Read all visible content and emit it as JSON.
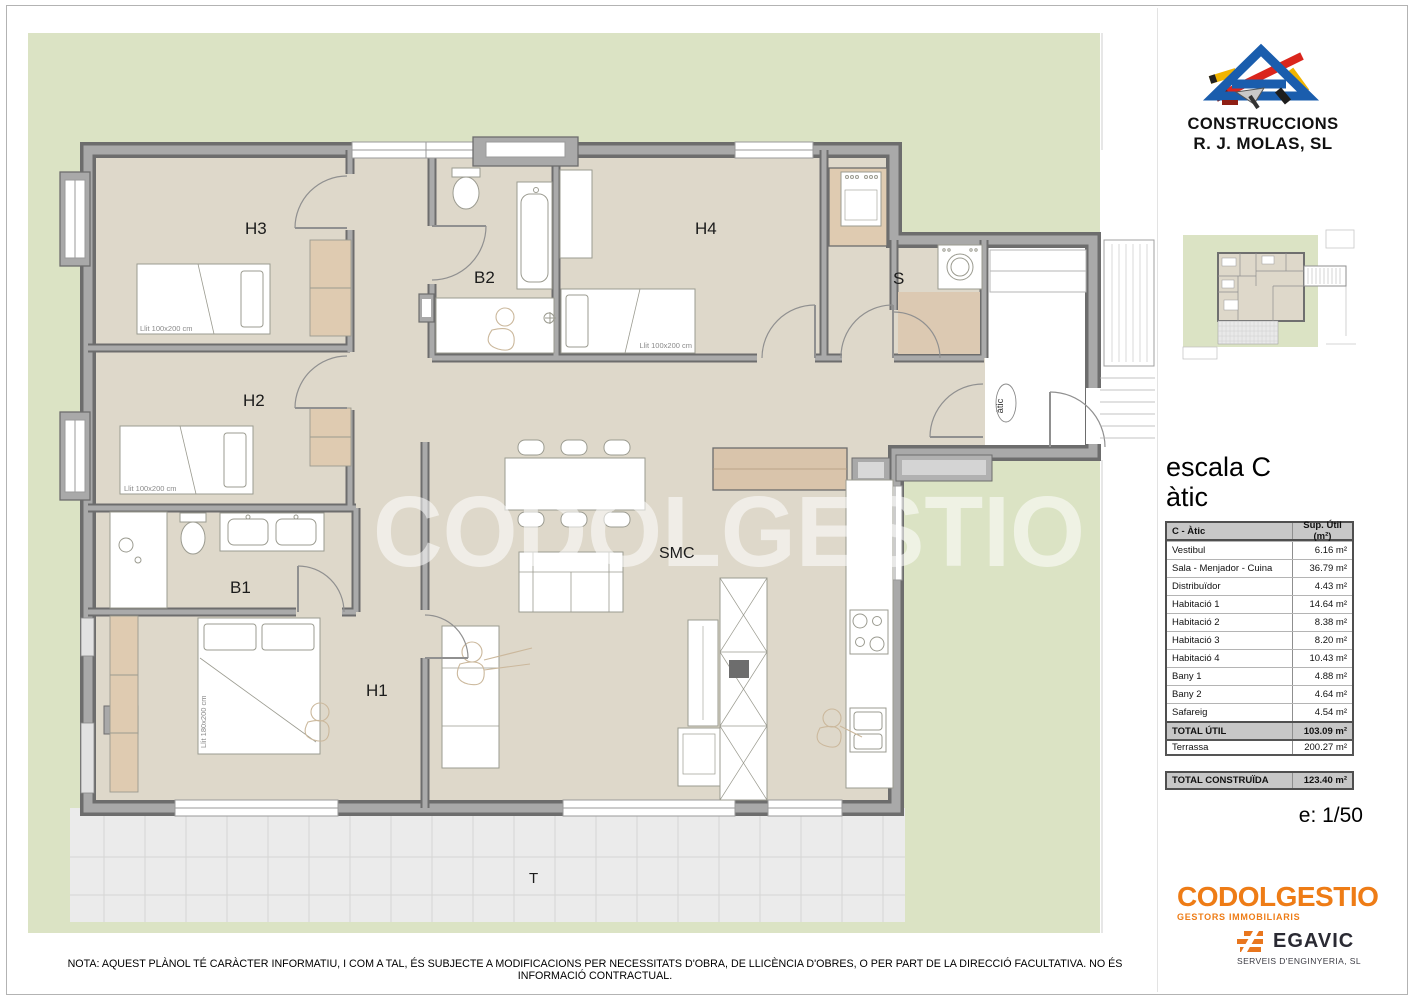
{
  "plan": {
    "watermark": "CODOLGESTIO",
    "entry_tag": "àtic",
    "rooms": {
      "h3": "H3",
      "b2": "B2",
      "h4": "H4",
      "s": "S",
      "h2": "H2",
      "b1": "B1",
      "h1": "H1",
      "smc": "SMC",
      "t": "T"
    },
    "beds": {
      "h3": "Llit 100x200 cm",
      "h2": "Llit 100x200 cm",
      "h4": "Llit 100x200 cm",
      "h1": "Llit 180x200 cm"
    }
  },
  "builder_logo": {
    "line1": "CONSTRUCCIONS",
    "line2": "R. J. MOLAS, SL"
  },
  "panel": {
    "heading_line1": "escala C",
    "heading_line2": "àtic",
    "table": {
      "col1": "C - Àtic",
      "col2": "Sup. Útil (m²)",
      "rows": [
        {
          "name": "Vestibul",
          "value": "6.16 m²"
        },
        {
          "name": "Sala - Menjador - Cuina",
          "value": "36.79 m²"
        },
        {
          "name": "Distribuïdor",
          "value": "4.43 m²"
        },
        {
          "name": "Habitació 1",
          "value": "14.64 m²"
        },
        {
          "name": "Habitació 2",
          "value": "8.38 m²"
        },
        {
          "name": "Habitació 3",
          "value": "8.20 m²"
        },
        {
          "name": "Habitació 4",
          "value": "10.43 m²"
        },
        {
          "name": "Bany 1",
          "value": "4.88 m²"
        },
        {
          "name": "Bany 2",
          "value": "4.64 m²"
        },
        {
          "name": "Safareig",
          "value": "4.54 m²"
        }
      ],
      "total_label": "TOTAL ÚTIL",
      "total_value": "103.09 m²"
    },
    "terrassa_label": "Terrassa",
    "terrassa_value": "200.27 m²",
    "built_label": "TOTAL CONSTRUÏDA",
    "built_value": "123.40 m²",
    "scale_label": "e: 1/50"
  },
  "footer_logos": {
    "codolgestio": "CODOLGESTIO",
    "codolgestio_tagline": "GESTORS IMMOBILIARIS",
    "egavic": "EGAVIC",
    "egavic_tagline": "SERVEIS D'ENGINYERIA, SL"
  },
  "note": "NOTA: AQUEST PLÀNOL TÉ CARÀCTER INFORMATIU, I COM A TAL, ÉS SUBJECTE A MODIFICACIONS PER NECESSITATS D'OBRA, DE LLICÈNCIA D'OBRES, O PER PART DE LA DIRECCIÓ FACULTATIVA.  NO ÉS INFORMACIÓ CONTRACTUAL.",
  "colors": {
    "garden_green": "#dbe3c4",
    "floor_beige": "#ded8ca",
    "wardrobe_tan": "#dfcbb1",
    "wall_dark": "#6d6d6d",
    "wall_fill": "#a9a9a9",
    "tile_gray": "#ebebeb",
    "brand_orange": "#ee7c16",
    "logo_blue": "#1a5dad",
    "logo_red": "#da251c",
    "logo_yellow": "#f0b400"
  }
}
